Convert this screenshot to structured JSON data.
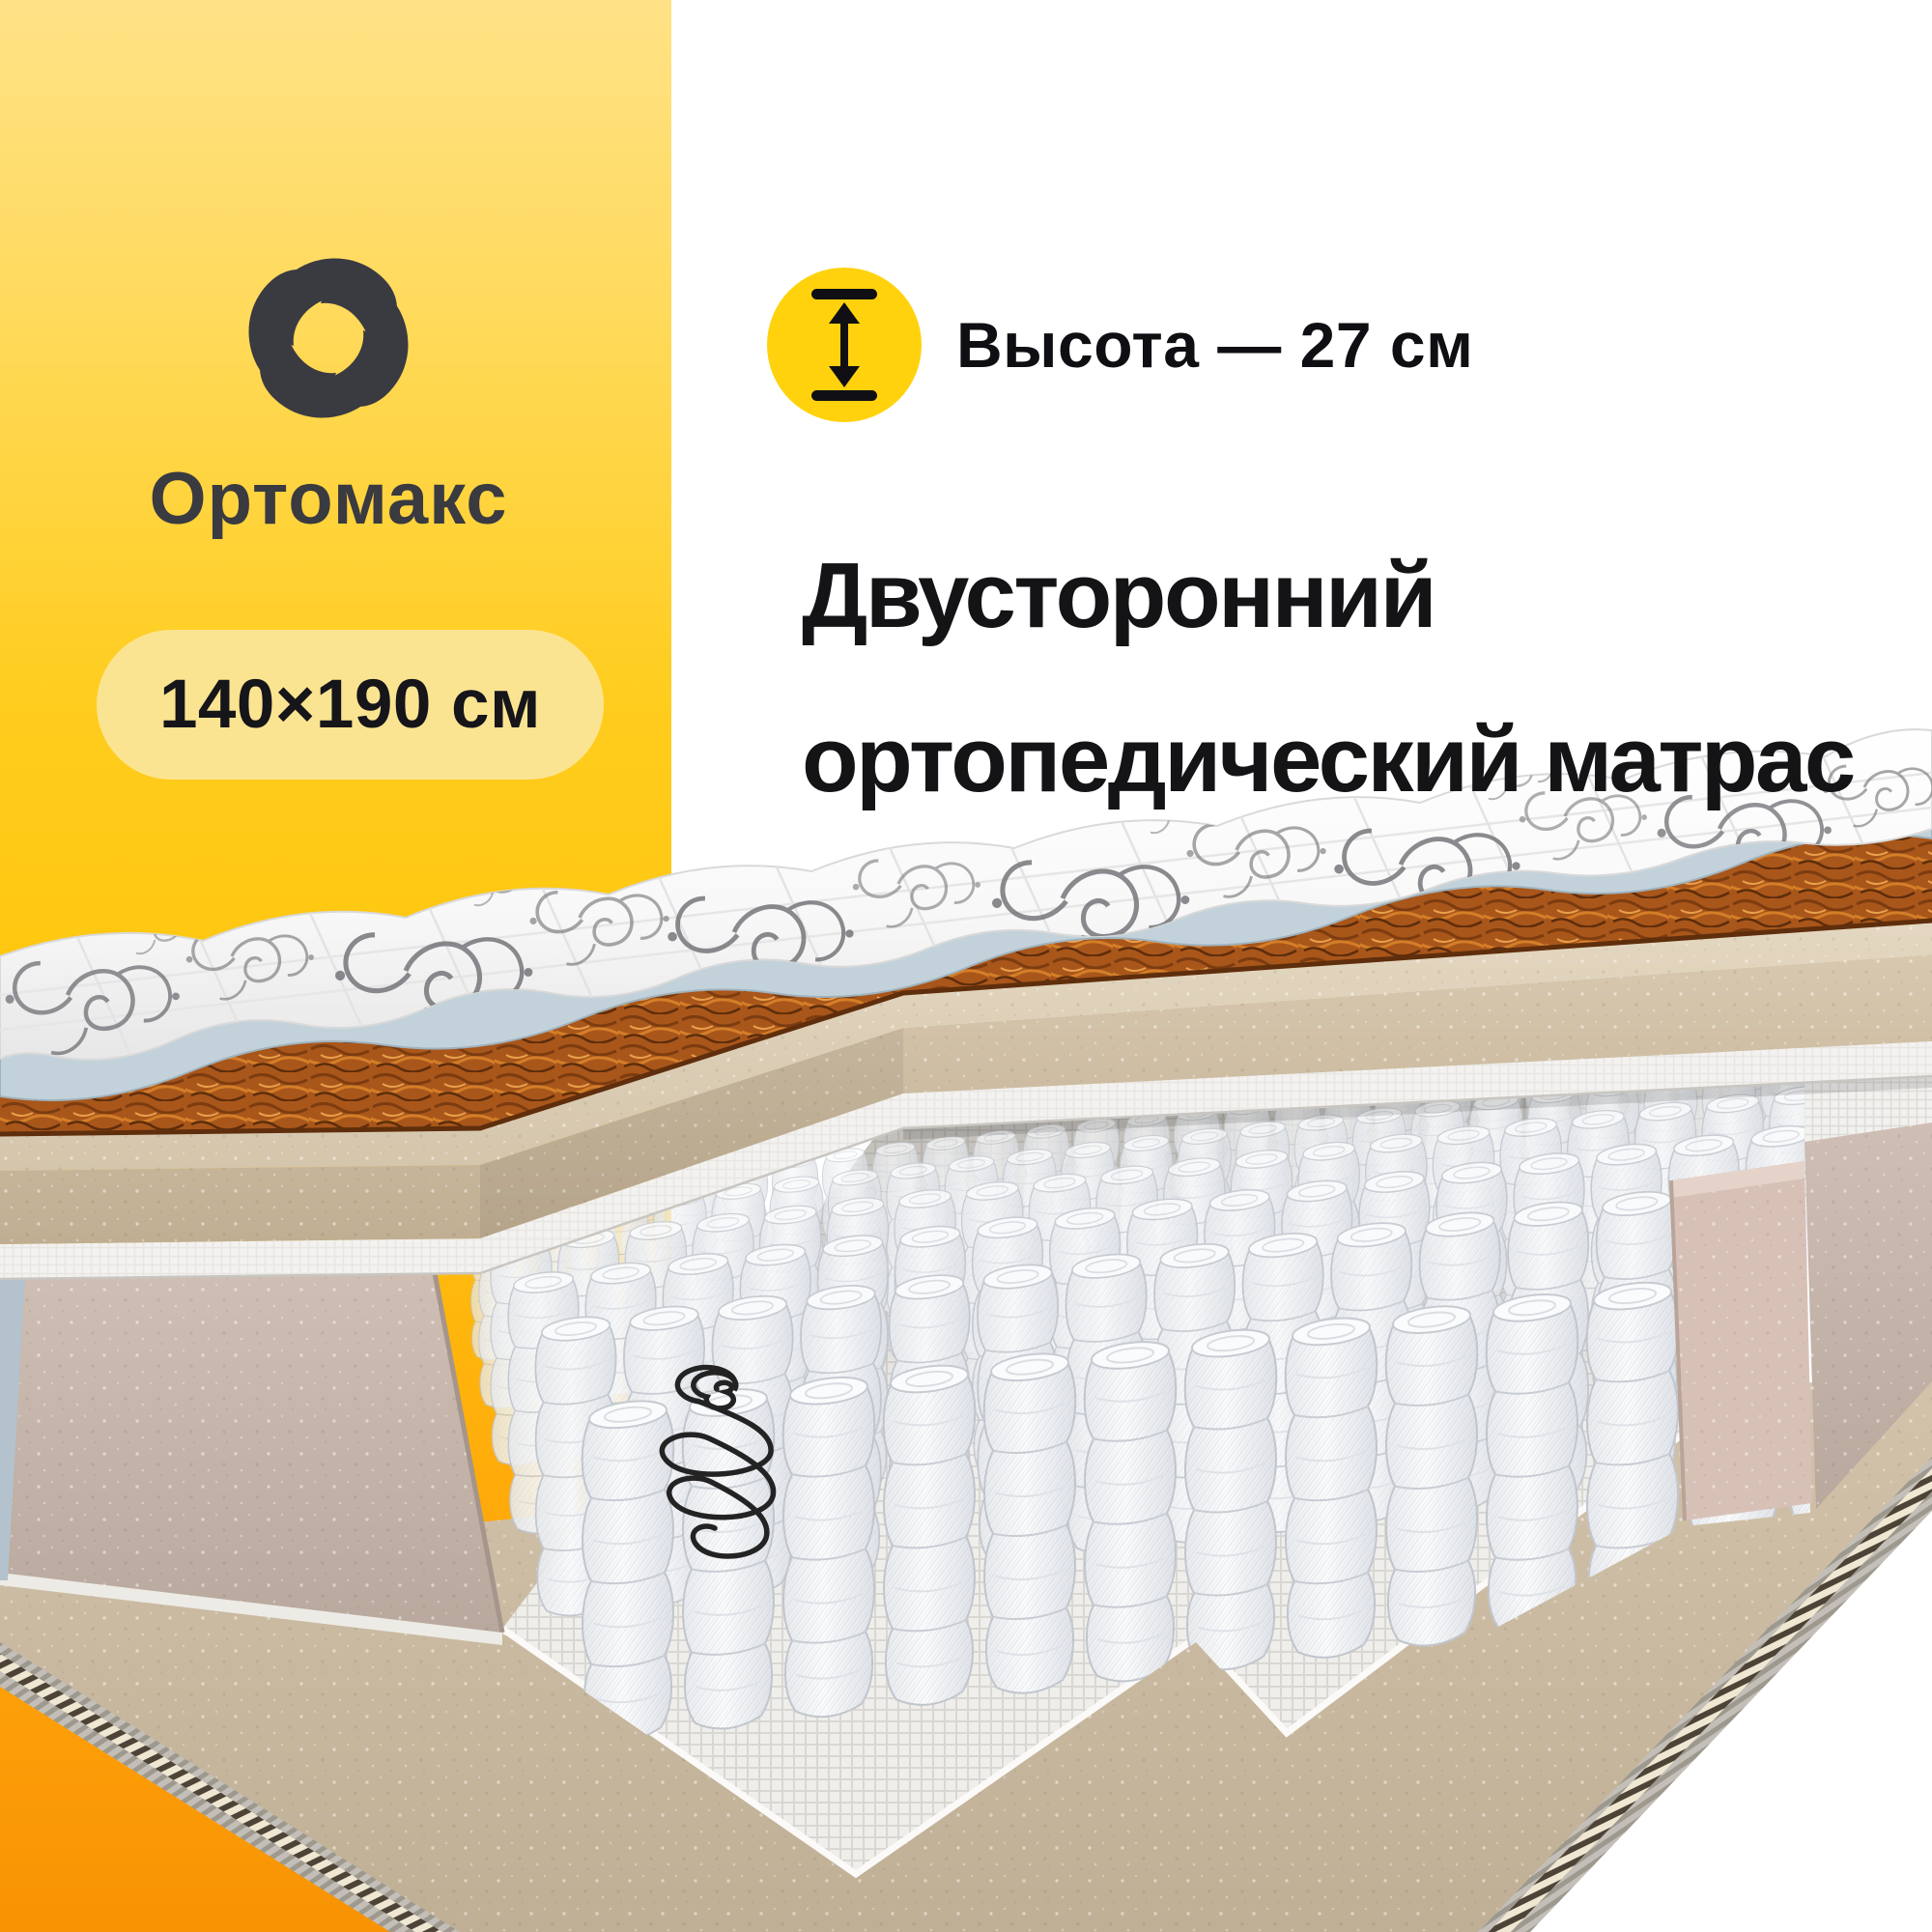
{
  "page": {
    "background": "#FFFFFF"
  },
  "accent_panel": {
    "gradient": [
      "#FFE286",
      "#FFDA5C",
      "#FFC60D",
      "#FFA50A",
      "#F89304"
    ]
  },
  "brand": {
    "name": "Ортомакс",
    "logo_icon": "knot-swirl-icon",
    "logo_color": "#3A3A41"
  },
  "size_badge": {
    "label": "140×190 см",
    "background": "#FBE491",
    "text_color": "#15151A"
  },
  "height_feature": {
    "icon": "height-double-arrow-icon",
    "circle_color": "#FFD20D",
    "label": "Высота — 27 см"
  },
  "heading": {
    "line1": "Двусторонний",
    "line2": "ортопедический матрас",
    "color": "#141417"
  },
  "illustration": {
    "name": "mattress-cutaway",
    "elements": [
      "quilted-cover",
      "cover-underside",
      "coconut-coir-layer",
      "foam-layer",
      "felt-layer",
      "pocket-springs",
      "spring-coil-sketch",
      "mattress-base",
      "edge-piping"
    ],
    "colors": {
      "cover": "#FAFAFA",
      "underside_blue": "#C3D2DA",
      "coir": "#A9561B",
      "foam": "#CDBCA2",
      "springs": "#F4F5F7",
      "base": "#CBBBA3",
      "knit": "#BDB9B2",
      "orange_bg": "#FF9B07"
    }
  }
}
